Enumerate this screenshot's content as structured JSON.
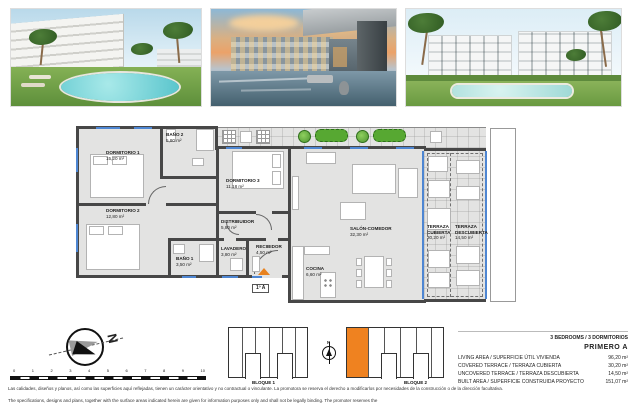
{
  "photos": [
    {
      "name": "render-pool-garden-day"
    },
    {
      "name": "render-pool-terrace-sunset"
    },
    {
      "name": "render-facade-pool-day"
    }
  ],
  "plan": {
    "rooms": [
      {
        "name": "DORMITORIO 1",
        "area": "15,20 m²"
      },
      {
        "name": "BAÑO 2",
        "area": "5,80 m²"
      },
      {
        "name": "DORMITORIO 2",
        "area": "12,80 m²"
      },
      {
        "name": "DORMITORIO 3",
        "area": "11,18 m²"
      },
      {
        "name": "BAÑO 1",
        "area": "3,50 m²"
      },
      {
        "name": "LAVADERO",
        "area": "3,80 m²"
      },
      {
        "name": "DISTRIBUIDOR",
        "area": "5,80 m²"
      },
      {
        "name": "RECIBIDOR",
        "area": "4,50 m²"
      },
      {
        "name": "COCINA",
        "area": "6,60 m²"
      },
      {
        "name": "SALÓN-COMEDOR",
        "area": "32,30 m²"
      },
      {
        "name": "TERRAZA CUBIERTA",
        "area": "30,20 m²"
      },
      {
        "name": "TERRAZA DESCUBIERTA",
        "area": "14,50 m²"
      }
    ],
    "entry_label": "1º A"
  },
  "summary": {
    "bedrooms_line": "3 BEDROOMS / 3 DORMITORIOS",
    "unit_title": "PRIMERO A",
    "rows": [
      {
        "label": "LIVING AREA / SUPERFICIE ÚTIL VIVIENDA",
        "value": "96,20 m²"
      },
      {
        "label": "COVERED TERRACE / TERRAZA CUBIERTA",
        "value": "30,20 m²"
      },
      {
        "label": "UNCOVERED TERRACE / TERRAZA DESCUBIERTA",
        "value": "14,50 m²"
      },
      {
        "label": "BUILT AREA / SUPERFICIE CONSTRUIDA PROYECTO",
        "value": "151,07 m²"
      }
    ]
  },
  "key_plan": {
    "bloque1_label": "BLOQUE 1",
    "bloque2_label": "BLOQUE 2",
    "north_label": "N"
  },
  "compass": {
    "north_label": "N"
  },
  "scale_bar": {
    "ticks": [
      "0",
      "1",
      "2",
      "3",
      "4",
      "5",
      "6",
      "7",
      "8",
      "9",
      "10"
    ]
  },
  "disclaimer": {
    "es": "Las calidades, diseños y planos, así como las superficies aquí reflejadas, tienen un carácter orientativo y no contractual o vinculante. La promotora se reserva el derecho a modificarlos por necesidades de la construcción o de la dirección facultativa.",
    "en": "The specifications, designs and plans, together with the surface areas indicated herein are given for information purposes only and shall not be legally binding. The promoter reserves the"
  },
  "colors": {
    "wall": "#474747",
    "window_blue": "#4e86d2",
    "highlight_orange": "#ef8220",
    "vegetation_green": "#57a832"
  }
}
